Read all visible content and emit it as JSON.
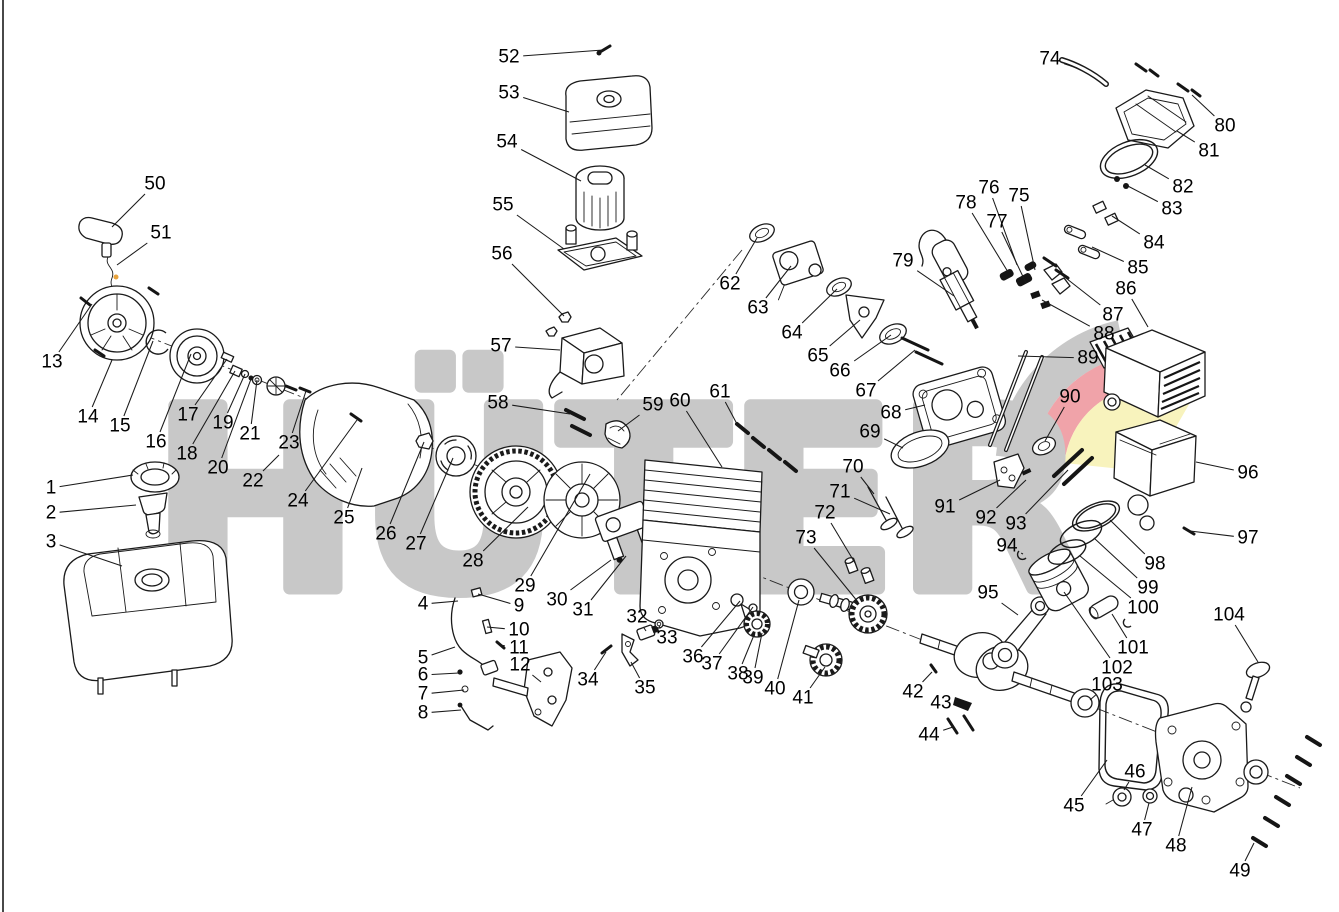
{
  "watermark": {
    "text": "HÜTER",
    "color": "#c8c8c8",
    "swoosh_gray": "#c8c8c8",
    "swoosh_red": "#f0a3a9",
    "swoosh_yellow": "#f8f3bd"
  },
  "frame": {
    "background": "#ffffff",
    "line_color": "#1a1a1a"
  },
  "callouts": [
    {
      "n": "1",
      "x": 51,
      "y": 488,
      "tx": 133,
      "ty": 475
    },
    {
      "n": "2",
      "x": 51,
      "y": 513,
      "tx": 136,
      "ty": 505
    },
    {
      "n": "3",
      "x": 51,
      "y": 542,
      "tx": 122,
      "ty": 566
    },
    {
      "n": "4",
      "x": 423,
      "y": 604,
      "tx": 458,
      "ty": 601
    },
    {
      "n": "5",
      "x": 423,
      "y": 658,
      "tx": 455,
      "ty": 647
    },
    {
      "n": "6",
      "x": 423,
      "y": 675,
      "tx": 459,
      "ty": 673
    },
    {
      "n": "7",
      "x": 423,
      "y": 694,
      "tx": 464,
      "ty": 690
    },
    {
      "n": "8",
      "x": 423,
      "y": 713,
      "tx": 461,
      "ty": 710
    },
    {
      "n": "9",
      "x": 519,
      "y": 606,
      "tx": 478,
      "ty": 594
    },
    {
      "n": "10",
      "x": 519,
      "y": 630,
      "tx": 487,
      "ty": 627
    },
    {
      "n": "11",
      "x": 519,
      "y": 648,
      "tx": 500,
      "ty": 645
    },
    {
      "n": "12",
      "x": 520,
      "y": 665,
      "tx": 541,
      "ty": 682
    },
    {
      "n": "13",
      "x": 52,
      "y": 362,
      "tx": 92,
      "ty": 304
    },
    {
      "n": "14",
      "x": 88,
      "y": 417,
      "tx": 112,
      "ty": 360
    },
    {
      "n": "15",
      "x": 120,
      "y": 426,
      "tx": 153,
      "ty": 341
    },
    {
      "n": "16",
      "x": 156,
      "y": 442,
      "tx": 191,
      "ty": 354
    },
    {
      "n": "17",
      "x": 188,
      "y": 415,
      "tx": 227,
      "ty": 359
    },
    {
      "n": "18",
      "x": 187,
      "y": 454,
      "tx": 235,
      "ty": 371
    },
    {
      "n": "19",
      "x": 223,
      "y": 423,
      "tx": 245,
      "ty": 374
    },
    {
      "n": "20",
      "x": 218,
      "y": 468,
      "tx": 251,
      "ty": 379
    },
    {
      "n": "21",
      "x": 250,
      "y": 434,
      "tx": 257,
      "ty": 380
    },
    {
      "n": "22",
      "x": 253,
      "y": 481,
      "tx": 279,
      "ty": 455
    },
    {
      "n": "23",
      "x": 289,
      "y": 443,
      "tx": 306,
      "ty": 391
    },
    {
      "n": "24",
      "x": 298,
      "y": 501,
      "tx": 357,
      "ty": 420
    },
    {
      "n": "25",
      "x": 344,
      "y": 518,
      "tx": 362,
      "ty": 468
    },
    {
      "n": "26",
      "x": 386,
      "y": 534,
      "tx": 424,
      "ty": 442
    },
    {
      "n": "27",
      "x": 416,
      "y": 544,
      "tx": 453,
      "ty": 458
    },
    {
      "n": "28",
      "x": 473,
      "y": 561,
      "tx": 528,
      "ty": 507
    },
    {
      "n": "29",
      "x": 525,
      "y": 586,
      "tx": 590,
      "ty": 474
    },
    {
      "n": "30",
      "x": 557,
      "y": 600,
      "tx": 611,
      "ty": 560
    },
    {
      "n": "31",
      "x": 583,
      "y": 610,
      "tx": 626,
      "ty": 556
    },
    {
      "n": "32",
      "x": 637,
      "y": 617,
      "tx": 646,
      "ty": 631
    },
    {
      "n": "33",
      "x": 667,
      "y": 638,
      "tx": 659,
      "ty": 626
    },
    {
      "n": "34",
      "x": 588,
      "y": 680,
      "tx": 606,
      "ty": 652
    },
    {
      "n": "35",
      "x": 645,
      "y": 688,
      "tx": 631,
      "ty": 662
    },
    {
      "n": "36",
      "x": 693,
      "y": 657,
      "tx": 740,
      "ty": 601
    },
    {
      "n": "37",
      "x": 712,
      "y": 664,
      "tx": 753,
      "ty": 607
    },
    {
      "n": "38",
      "x": 738,
      "y": 674,
      "tx": 754,
      "ty": 635
    },
    {
      "n": "39",
      "x": 753,
      "y": 678,
      "tx": 762,
      "ty": 633
    },
    {
      "n": "40",
      "x": 775,
      "y": 689,
      "tx": 799,
      "ty": 600
    },
    {
      "n": "41",
      "x": 803,
      "y": 698,
      "tx": 825,
      "ty": 667
    },
    {
      "n": "42",
      "x": 913,
      "y": 692,
      "tx": 932,
      "ty": 672
    },
    {
      "n": "43",
      "x": 941,
      "y": 703,
      "tx": 958,
      "ty": 701
    },
    {
      "n": "44",
      "x": 929,
      "y": 735,
      "tx": 953,
      "ty": 727
    },
    {
      "n": "45",
      "x": 1074,
      "y": 806,
      "tx": 1107,
      "ty": 760
    },
    {
      "n": "46",
      "x": 1135,
      "y": 772,
      "tx": 1124,
      "ty": 790
    },
    {
      "n": "47",
      "x": 1142,
      "y": 830,
      "tx": 1149,
      "ty": 803
    },
    {
      "n": "48",
      "x": 1176,
      "y": 846,
      "tx": 1192,
      "ty": 787
    },
    {
      "n": "49",
      "x": 1240,
      "y": 871,
      "tx": 1254,
      "ty": 843
    },
    {
      "n": "50",
      "x": 155,
      "y": 184,
      "tx": 112,
      "ty": 227
    },
    {
      "n": "51",
      "x": 161,
      "y": 233,
      "tx": 117,
      "ty": 265
    },
    {
      "n": "52",
      "x": 509,
      "y": 57,
      "tx": 603,
      "ty": 50
    },
    {
      "n": "53",
      "x": 509,
      "y": 93,
      "tx": 569,
      "ty": 112
    },
    {
      "n": "54",
      "x": 507,
      "y": 142,
      "tx": 581,
      "ty": 181
    },
    {
      "n": "55",
      "x": 503,
      "y": 205,
      "tx": 564,
      "ty": 249
    },
    {
      "n": "56",
      "x": 502,
      "y": 254,
      "tx": 564,
      "ty": 316
    },
    {
      "n": "57",
      "x": 501,
      "y": 346,
      "tx": 560,
      "ty": 350
    },
    {
      "n": "58",
      "x": 498,
      "y": 403,
      "tx": 570,
      "ty": 414
    },
    {
      "n": "59",
      "x": 653,
      "y": 405,
      "tx": 618,
      "ty": 431
    },
    {
      "n": "60",
      "x": 680,
      "y": 401,
      "tx": 722,
      "ty": 467
    },
    {
      "n": "61",
      "x": 720,
      "y": 392,
      "tx": 737,
      "ty": 424
    },
    {
      "n": "62",
      "x": 730,
      "y": 284,
      "tx": 757,
      "ty": 238
    },
    {
      "n": "63",
      "x": 758,
      "y": 308,
      "tx": 791,
      "ty": 266
    },
    {
      "n": "64",
      "x": 792,
      "y": 333,
      "tx": 837,
      "ty": 289
    },
    {
      "n": "65",
      "x": 818,
      "y": 356,
      "tx": 860,
      "ty": 320
    },
    {
      "n": "66",
      "x": 840,
      "y": 371,
      "tx": 891,
      "ty": 335
    },
    {
      "n": "67",
      "x": 866,
      "y": 391,
      "tx": 915,
      "ty": 350
    },
    {
      "n": "68",
      "x": 891,
      "y": 413,
      "tx": 925,
      "ty": 405
    },
    {
      "n": "69",
      "x": 870,
      "y": 432,
      "tx": 903,
      "ty": 448
    },
    {
      "n": "70",
      "x": 853,
      "y": 467,
      "tx": 874,
      "ty": 494
    },
    {
      "n": "71",
      "x": 840,
      "y": 492,
      "tx": 890,
      "ty": 514
    },
    {
      "n": "72",
      "x": 825,
      "y": 513,
      "tx": 855,
      "ty": 563
    },
    {
      "n": "73",
      "x": 806,
      "y": 538,
      "tx": 858,
      "ty": 602
    },
    {
      "n": "74",
      "x": 1050,
      "y": 59,
      "tx": 1077,
      "ty": 68
    },
    {
      "n": "75",
      "x": 1019,
      "y": 196,
      "tx": 1035,
      "ty": 270
    },
    {
      "n": "76",
      "x": 989,
      "y": 188,
      "tx": 1017,
      "ty": 265
    },
    {
      "n": "77",
      "x": 997,
      "y": 222,
      "tx": 1026,
      "ty": 283
    },
    {
      "n": "78",
      "x": 966,
      "y": 203,
      "tx": 1008,
      "ty": 272
    },
    {
      "n": "79",
      "x": 903,
      "y": 261,
      "tx": 954,
      "ty": 296
    },
    {
      "n": "80",
      "x": 1225,
      "y": 126,
      "tx": 1192,
      "ty": 95
    },
    {
      "n": "81",
      "x": 1209,
      "y": 151,
      "tx": 1177,
      "ty": 131
    },
    {
      "n": "82",
      "x": 1183,
      "y": 187,
      "tx": 1145,
      "ty": 165
    },
    {
      "n": "83",
      "x": 1172,
      "y": 209,
      "tx": 1124,
      "ty": 184
    },
    {
      "n": "84",
      "x": 1154,
      "y": 243,
      "tx": 1112,
      "ty": 216
    },
    {
      "n": "85",
      "x": 1138,
      "y": 268,
      "tx": 1092,
      "ty": 247
    },
    {
      "n": "86",
      "x": 1126,
      "y": 289,
      "tx": 1148,
      "ty": 327
    },
    {
      "n": "87",
      "x": 1113,
      "y": 315,
      "tx": 1062,
      "ty": 275
    },
    {
      "n": "88",
      "x": 1104,
      "y": 334,
      "tx": 1042,
      "ty": 300
    },
    {
      "n": "89",
      "x": 1088,
      "y": 358,
      "tx": 1018,
      "ty": 356
    },
    {
      "n": "90",
      "x": 1070,
      "y": 397,
      "tx": 1045,
      "ty": 441
    },
    {
      "n": "91",
      "x": 945,
      "y": 507,
      "tx": 1000,
      "ty": 480
    },
    {
      "n": "92",
      "x": 986,
      "y": 518,
      "tx": 1026,
      "ty": 480
    },
    {
      "n": "93",
      "x": 1016,
      "y": 524,
      "tx": 1068,
      "ty": 470
    },
    {
      "n": "94",
      "x": 1007,
      "y": 546,
      "tx": 1023,
      "ty": 554
    },
    {
      "n": "95",
      "x": 988,
      "y": 593,
      "tx": 1018,
      "ty": 615
    },
    {
      "n": "96",
      "x": 1248,
      "y": 473,
      "tx": 1196,
      "ty": 462
    },
    {
      "n": "97",
      "x": 1248,
      "y": 538,
      "tx": 1190,
      "ty": 531
    },
    {
      "n": "98",
      "x": 1155,
      "y": 564,
      "tx": 1110,
      "ty": 520
    },
    {
      "n": "99",
      "x": 1148,
      "y": 588,
      "tx": 1094,
      "ty": 538
    },
    {
      "n": "100",
      "x": 1143,
      "y": 608,
      "tx": 1080,
      "ty": 556
    },
    {
      "n": "101",
      "x": 1133,
      "y": 648,
      "tx": 1112,
      "ty": 614
    },
    {
      "n": "102",
      "x": 1117,
      "y": 668,
      "tx": 1064,
      "ty": 592
    },
    {
      "n": "103",
      "x": 1107,
      "y": 685,
      "tx": 1090,
      "ty": 700
    },
    {
      "n": "104",
      "x": 1229,
      "y": 615,
      "tx": 1258,
      "ty": 662
    }
  ]
}
